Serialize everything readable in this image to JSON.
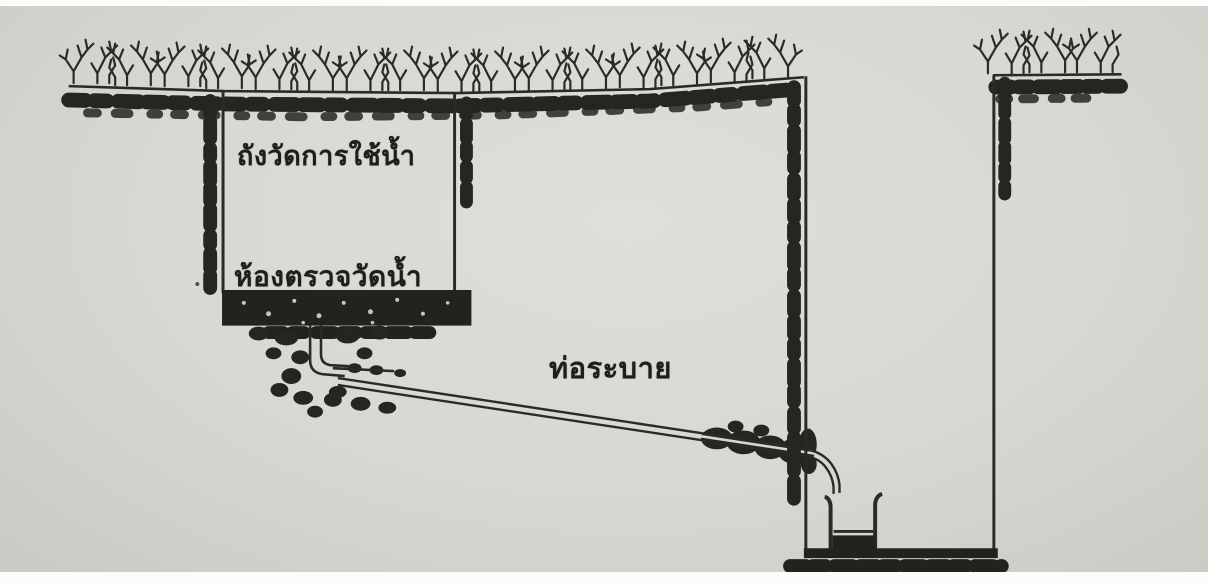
{
  "scene": {
    "description": "Scanned hand-drawn cross-section: buried water-measuring tank draining via pipe into a deep open pit",
    "paper_color": "#d9d7d1",
    "ink_color": "#2b2a26",
    "labels": {
      "tank": "ถังวัดการใช้น้ำ",
      "chamber": "ห้องตรวจวัดน้ำ",
      "drain_pipe": "ท่อระบาย"
    }
  }
}
